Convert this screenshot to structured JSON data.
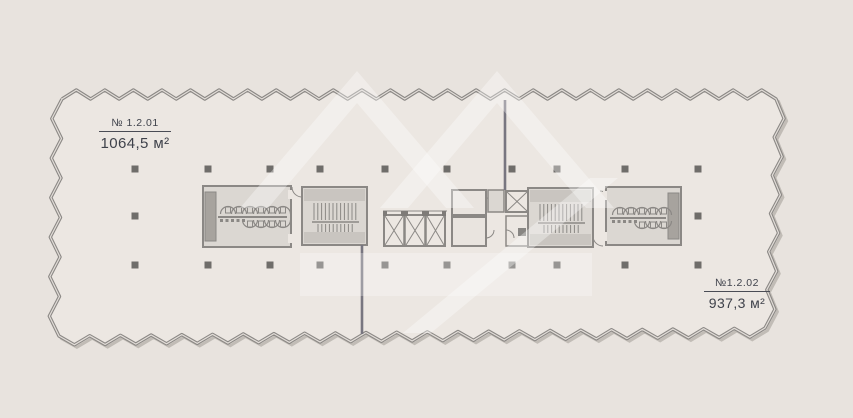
{
  "plan": {
    "units": [
      {
        "id": "unit-1",
        "number": "№ 1.2.01",
        "area": "1064,5 м²"
      },
      {
        "id": "unit-2",
        "number": "№1.2.02",
        "area": "937,3 м²"
      }
    ],
    "colors": {
      "background": "#e8e3de",
      "interior": "#ece7e2",
      "wall": "#8b8885",
      "core_fill": "#dbd7d2",
      "stair_band": "#c9c5c0",
      "shaft_dark": "#a7a39e",
      "column": "#6f6d6a",
      "label_text": "#3f424b",
      "watermark": "#ffffff"
    }
  }
}
